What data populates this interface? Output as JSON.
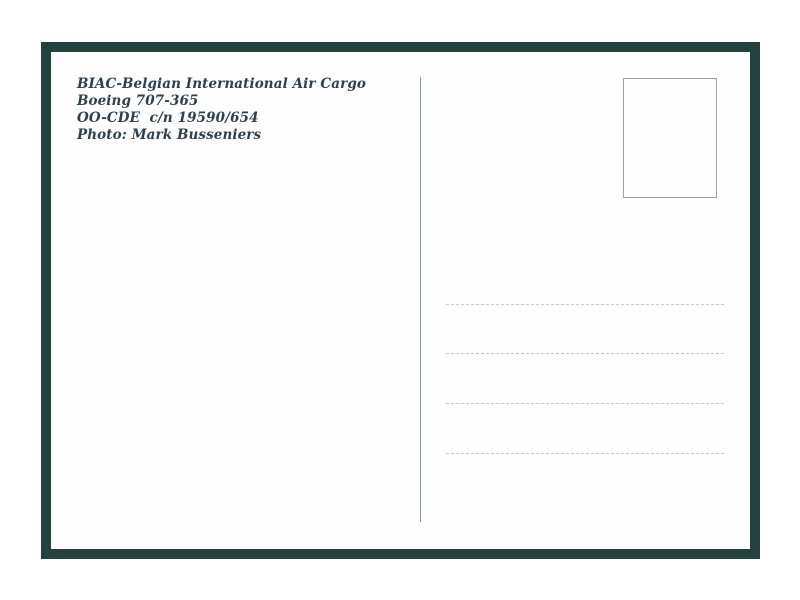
{
  "postcard": {
    "caption_lines": [
      "BIAC-Belgian International Air Cargo",
      "Boeing 707-365",
      "OO-CDE  c/n 19590/654",
      "Photo: Mark Busseniers"
    ],
    "address_lines_count": 4,
    "colors": {
      "page_background": "#ffffff",
      "frame": "#24423d",
      "card": "#fdfefd",
      "caption_text": "#2e3f4d",
      "divider": "#8e9997",
      "stamp_border": "#9ba4a2",
      "address_line": "#c6cbca"
    }
  }
}
